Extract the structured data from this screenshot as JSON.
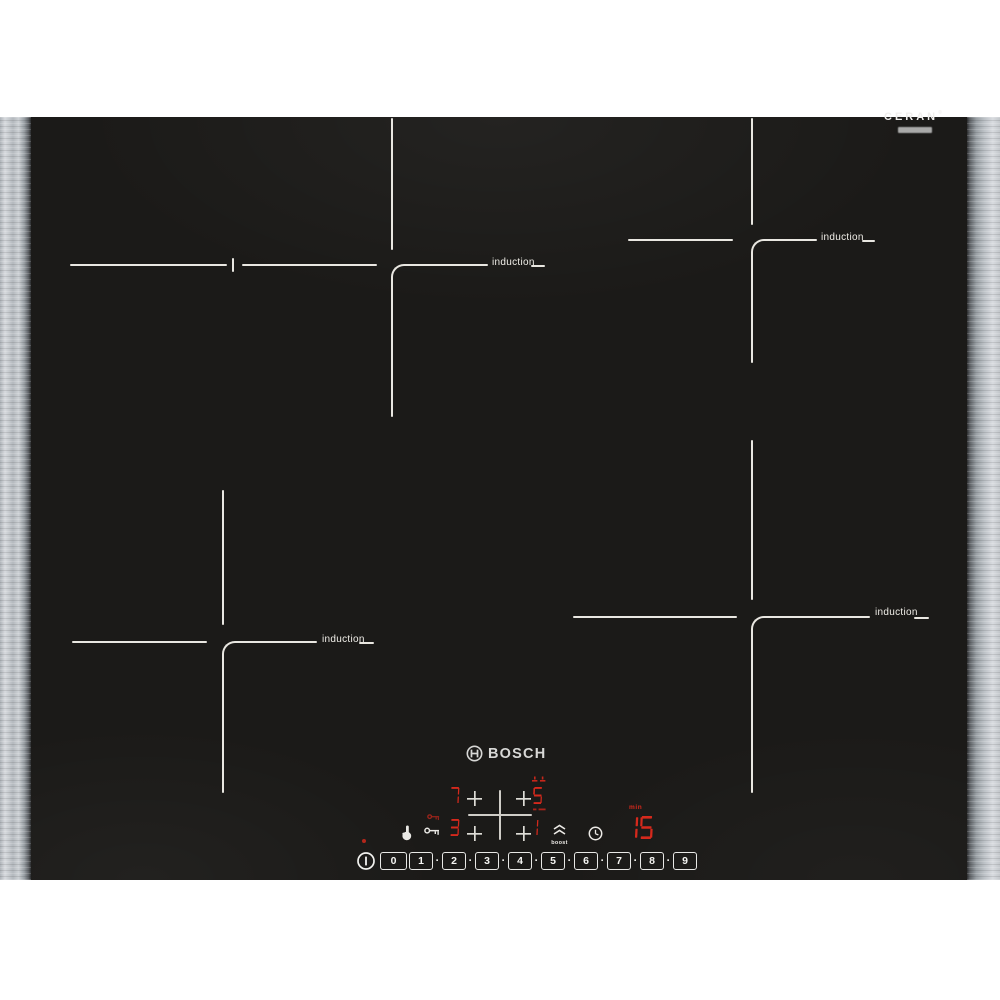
{
  "branding": {
    "ceran": "CERAN",
    "ceran_mark": "®",
    "bosch": "BOSCH"
  },
  "zones": [
    {
      "id": "top-left",
      "label": "induction"
    },
    {
      "id": "top-right",
      "label": "induction"
    },
    {
      "id": "bottom-left",
      "label": "induction"
    },
    {
      "id": "bottom-right",
      "label": "induction"
    }
  ],
  "controls": {
    "zone_display": {
      "top_left": "7",
      "top_right": "5",
      "bottom_left": "3",
      "bottom_right": "1"
    },
    "timer": {
      "value": "15",
      "unit": "min"
    },
    "boost_label": "boost",
    "slider": {
      "levels": [
        "0",
        "1",
        "2",
        "3",
        "4",
        "5",
        "6",
        "7",
        "8",
        "9"
      ],
      "dot": "·"
    },
    "icons": {
      "power": "circle-with-I",
      "power-indicator": "red-dot",
      "wipe-protection": "hand",
      "child-lock": "key",
      "child-lock-indicator": "red-key",
      "bridge-zone-indicator": "bridge-bars",
      "frying-sensor-indicator": "red-dashes",
      "boost": "double-chevron-up",
      "timer": "clock",
      "bosch-symbol": "circle-armature"
    }
  },
  "colors": {
    "led_red": "#d5291c",
    "surface_black": "#1b1a18",
    "marking_white": "#e9e7e1",
    "steel_light": "#d7dade",
    "steel_dark": "#2c2d2f"
  }
}
